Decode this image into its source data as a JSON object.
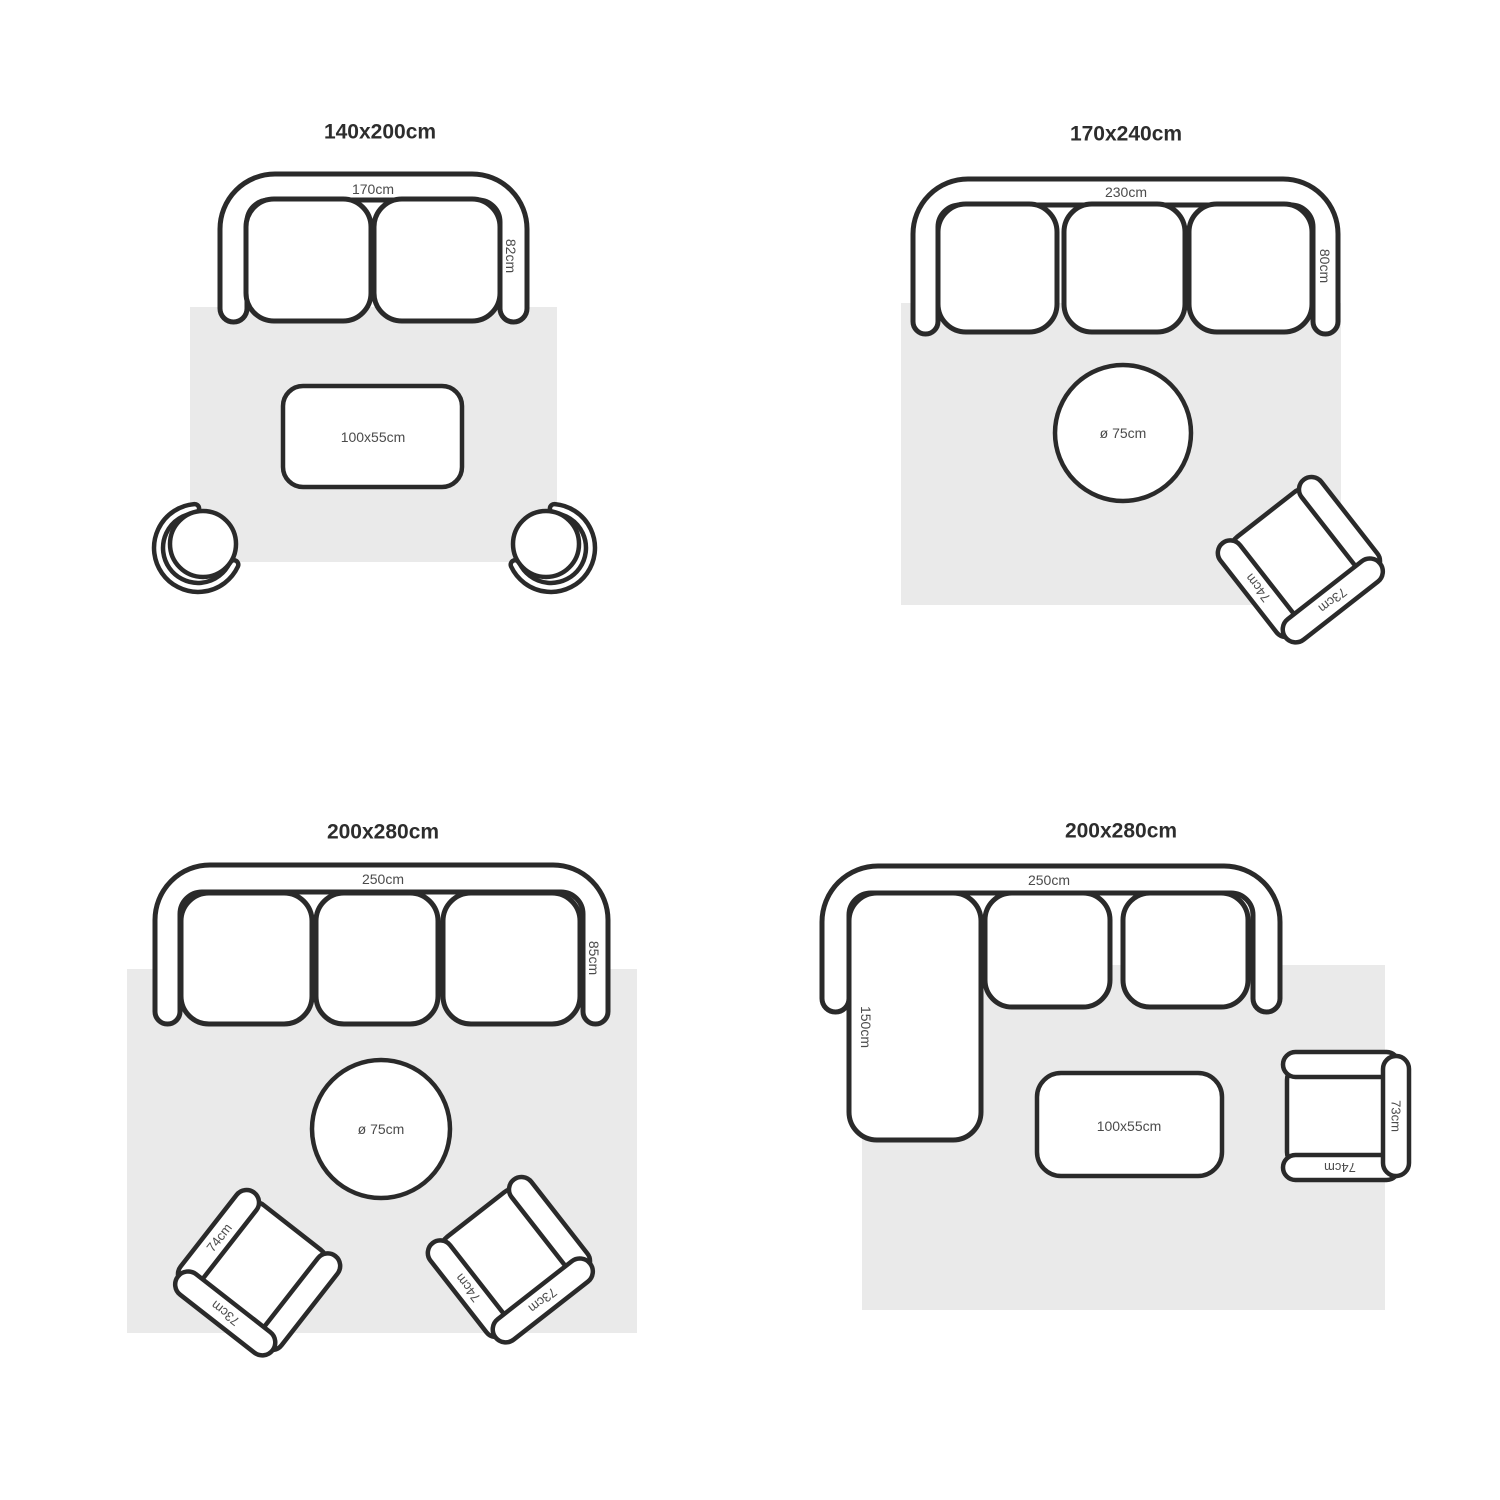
{
  "colors": {
    "background": "#ffffff",
    "outline": "#2a2a2a",
    "rug": "#eaeaea",
    "furniture": "#ffffff",
    "label": "#4b4b4b",
    "title": "#2d2d2d"
  },
  "layouts": [
    {
      "title": "140x200cm",
      "sofa_width": "170cm",
      "sofa_depth": "82cm",
      "coffee_table": "100x55cm"
    },
    {
      "title": "170x240cm",
      "sofa_width": "230cm",
      "sofa_depth": "80cm",
      "round_table": "ø 75cm",
      "armchair": {
        "arm": "74cm",
        "back": "73cm"
      }
    },
    {
      "title": "200x280cm",
      "sofa_width": "250cm",
      "sofa_depth": "85cm",
      "round_table": "ø 75cm",
      "armchair_left": {
        "arm": "74cm",
        "back": "73cm"
      },
      "armchair_right": {
        "arm": "74cm",
        "back": "73cm"
      }
    },
    {
      "title": "200x280cm",
      "sofa_width": "250cm",
      "chaise_depth": "150cm",
      "coffee_table": "100x55cm",
      "armchair": {
        "arm": "74cm",
        "back": "73cm"
      }
    }
  ]
}
